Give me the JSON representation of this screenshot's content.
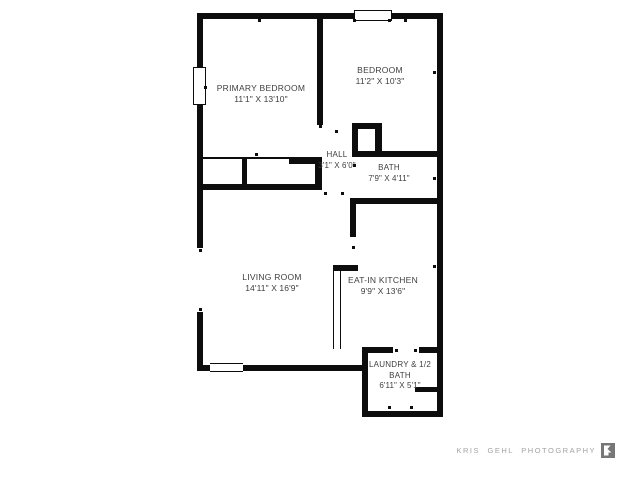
{
  "floorplan": {
    "wall_color": "#0d0d0d",
    "text_color": "#3e3e3e",
    "rooms": [
      {
        "name": "PRIMARY BEDROOM",
        "dims": "11'1\" x 13'10\""
      },
      {
        "name": "BEDROOM",
        "dims": "11'2\" x 10'3\""
      },
      {
        "name": "HALL",
        "dims": "3'1\" x 6'0\""
      },
      {
        "name": "BATH",
        "dims": "7'9\" x 4'11\""
      },
      {
        "name": "LIVING ROOM",
        "dims": "14'11\" x 16'9\""
      },
      {
        "name": "EAT-IN KITCHEN",
        "dims": "9'9\" x 13'6\""
      },
      {
        "name": "LAUNDRY & 1/2 BATH",
        "dims": "6'11\" x 5'1\""
      }
    ]
  },
  "watermark": {
    "text": "KRIS GEHL PHOTOGRAPHY",
    "color": "#a2a2a2"
  }
}
